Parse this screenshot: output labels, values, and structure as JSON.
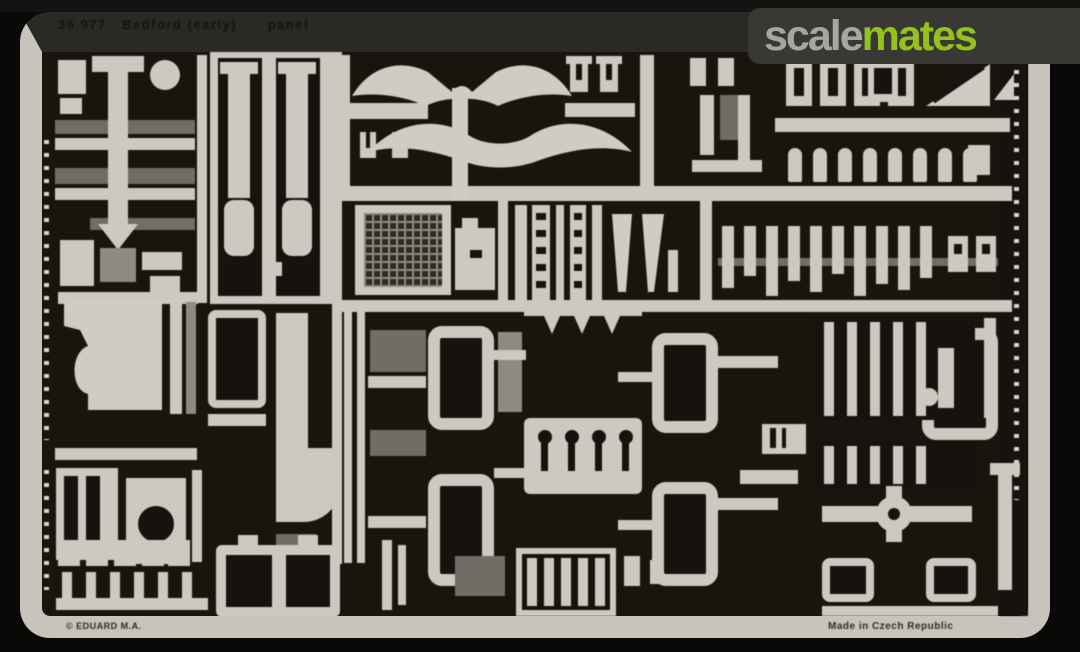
{
  "etched_text": {
    "top_title": "36 977   Bedford (early)      panel",
    "bottom_left": "© EDUARD M.A.",
    "bottom_right": "Made in Czech Republic"
  },
  "watermark": {
    "part1": "scale",
    "part2": "mates",
    "part1_color": "#a6a5a3",
    "part2_color": "#94c21d"
  },
  "colors": {
    "background": "#0a0908",
    "fret_metal": "#c7c4bc",
    "fret_backing": "#18140e",
    "half_etch": "#716d66"
  }
}
